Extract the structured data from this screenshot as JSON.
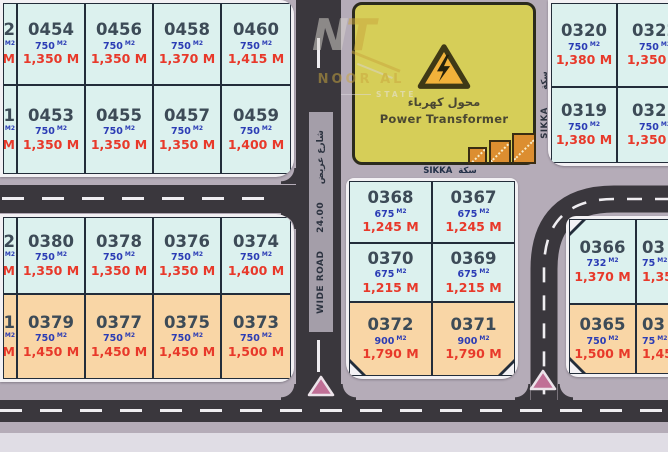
{
  "units": {
    "area": "M2"
  },
  "colors": {
    "plot_cyan": "#dcf1ee",
    "plot_orange": "#f9d6a6",
    "plot_border": "#232d3a",
    "number_text": "#3d4b57",
    "area_text": "#2b3cb5",
    "price_text": "#e8392a",
    "road": "#3a373d",
    "sidewalk": "#b5acb8",
    "block_outline": "#f3f1f4",
    "transformer_fill": "#d6ce58",
    "warning_fill": "#f2b23a",
    "marker_pink": "#c06f96",
    "steps_orange": "#dc8e30"
  },
  "roads": {
    "wide_road": {
      "name_latin": "WIDE ROAD",
      "width_label": "24.00",
      "name_arabic": "شارع عريض"
    },
    "sikka_horizontal": {
      "latin": "SIKKA",
      "arabic": "سكة"
    },
    "sikka_vertical": {
      "latin": "SIKKA",
      "arabic": "سكة"
    }
  },
  "transformer": {
    "label_arabic": "محول كهرباء",
    "label_english": "Power Transformer"
  },
  "watermark": {
    "monogram_n": "N",
    "monogram_t": "T",
    "name": "NOOR AL",
    "tagline": "STATE"
  },
  "blocks": {
    "top_left": [
      [
        {
          "number": "2",
          "area": "",
          "price": "M",
          "fill": "cyan",
          "clip": "right"
        },
        {
          "number": "0454",
          "area": "750",
          "price": "1,350 M",
          "fill": "cyan"
        },
        {
          "number": "0456",
          "area": "750",
          "price": "1,350 M",
          "fill": "cyan"
        },
        {
          "number": "0458",
          "area": "750",
          "price": "1,370 M",
          "fill": "cyan"
        },
        {
          "number": "0460",
          "area": "750",
          "price": "1,415 M",
          "fill": "cyan"
        }
      ],
      [
        {
          "number": "1",
          "area": "",
          "price": "M",
          "fill": "cyan",
          "clip": "right"
        },
        {
          "number": "0453",
          "area": "750",
          "price": "1,350 M",
          "fill": "cyan"
        },
        {
          "number": "0455",
          "area": "750",
          "price": "1,350 M",
          "fill": "cyan"
        },
        {
          "number": "0457",
          "area": "750",
          "price": "1,350 M",
          "fill": "cyan"
        },
        {
          "number": "0459",
          "area": "750",
          "price": "1,400 M",
          "fill": "cyan"
        }
      ]
    ],
    "mid_left": [
      [
        {
          "number": "2",
          "area": "",
          "price": "M",
          "fill": "cyan",
          "clip": "right"
        },
        {
          "number": "0380",
          "area": "750",
          "price": "1,350 M",
          "fill": "cyan"
        },
        {
          "number": "0378",
          "area": "750",
          "price": "1,350 M",
          "fill": "cyan"
        },
        {
          "number": "0376",
          "area": "750",
          "price": "1,350 M",
          "fill": "cyan"
        },
        {
          "number": "0374",
          "area": "750",
          "price": "1,400 M",
          "fill": "cyan"
        }
      ],
      [
        {
          "number": "1",
          "area": "",
          "price": "M",
          "fill": "orange",
          "clip": "right"
        },
        {
          "number": "0379",
          "area": "750",
          "price": "1,450 M",
          "fill": "orange"
        },
        {
          "number": "0377",
          "area": "750",
          "price": "1,450 M",
          "fill": "orange"
        },
        {
          "number": "0375",
          "area": "750",
          "price": "1,450 M",
          "fill": "orange"
        },
        {
          "number": "0373",
          "area": "750",
          "price": "1,500 M",
          "fill": "orange"
        }
      ]
    ],
    "center": [
      [
        {
          "number": "0368",
          "area": "675",
          "price": "1,245 M",
          "fill": "cyan"
        },
        {
          "number": "0367",
          "area": "675",
          "price": "1,245 M",
          "fill": "cyan"
        }
      ],
      [
        {
          "number": "0370",
          "area": "675",
          "price": "1,215 M",
          "fill": "cyan"
        },
        {
          "number": "0369",
          "area": "675",
          "price": "1,215 M",
          "fill": "cyan"
        }
      ],
      [
        {
          "number": "0372",
          "area": "900",
          "price": "1,790 M",
          "fill": "orange",
          "corner": "bl"
        },
        {
          "number": "0371",
          "area": "900",
          "price": "1,790 M",
          "fill": "orange",
          "corner": "br"
        }
      ]
    ],
    "top_right": [
      [
        {
          "number": "0320",
          "area": "750",
          "price": "1,380 M",
          "fill": "cyan"
        },
        {
          "number": "0322",
          "area": "750",
          "price": "1,350 M",
          "fill": "cyan"
        }
      ],
      [
        {
          "number": "0319",
          "area": "750",
          "price": "1,380 M",
          "fill": "cyan"
        },
        {
          "number": "0321",
          "area": "750",
          "price": "1,350 M",
          "fill": "cyan"
        }
      ]
    ],
    "right": [
      [
        {
          "number": "0366",
          "area": "732",
          "price": "1,370 M",
          "fill": "cyan",
          "corner": "tl"
        },
        {
          "number": "03",
          "area": "75",
          "price": "1,35",
          "fill": "cyan",
          "clip": "left"
        }
      ],
      [
        {
          "number": "0365",
          "area": "750",
          "price": "1,500 M",
          "fill": "orange",
          "corner": "bl"
        },
        {
          "number": "03",
          "area": "75",
          "price": "1,45",
          "fill": "orange",
          "clip": "left"
        }
      ]
    ]
  }
}
